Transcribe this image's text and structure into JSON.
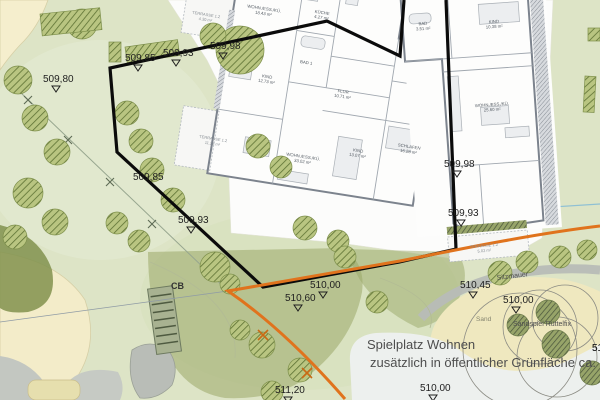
{
  "map": {
    "annotations": {
      "playground_line1": "Spielplatz Wohnen",
      "playground_line2": "zusätzlich in öffentlicher Grünfläche ca.",
      "seat_wall": "Sitzmauer",
      "sand": "Sand",
      "sand_play": "Sandspiel Rüttelfix",
      "cb": "CB",
      "partial_elevation": "51"
    },
    "elevation_markers": [
      {
        "label": "509,80",
        "x": 43,
        "y": 82
      },
      {
        "label": "509,85",
        "x": 125,
        "y": 61
      },
      {
        "label": "509,93",
        "x": 163,
        "y": 56
      },
      {
        "label": "509,98",
        "x": 210,
        "y": 49
      },
      {
        "label": "509,85",
        "x": 133,
        "y": 180,
        "tri": false
      },
      {
        "label": "509,93",
        "x": 178,
        "y": 223
      },
      {
        "label": "509,98",
        "x": 444,
        "y": 167
      },
      {
        "label": "509,93",
        "x": 448,
        "y": 216
      },
      {
        "label": "510,00",
        "x": 310,
        "y": 288
      },
      {
        "label": "510,60",
        "x": 285,
        "y": 301
      },
      {
        "label": "510,45",
        "x": 460,
        "y": 288
      },
      {
        "label": "510,00",
        "x": 503,
        "y": 303
      },
      {
        "label": "510,00",
        "x": 420,
        "y": 391
      },
      {
        "label": "511,20",
        "x": 275,
        "y": 393
      },
      {
        "label": "51",
        "x": 592,
        "y": 351,
        "tri": false
      }
    ],
    "rooms": [
      {
        "label": "WOHN./ESS./KÜ.",
        "area": "18.43 m²",
        "x": 264,
        "y": 10,
        "rot": 9
      },
      {
        "label": "KÜCHE",
        "area": "4.27 m²",
        "x": 322,
        "y": 14,
        "rot": 9
      },
      {
        "label": "KIND",
        "area": "12.73 m²",
        "x": 267,
        "y": 78,
        "rot": 9
      },
      {
        "label": "BAD 1",
        "area": "",
        "x": 306,
        "y": 64,
        "rot": 9
      },
      {
        "label": "FLUR",
        "area": "10.71 m²",
        "x": 343,
        "y": 93,
        "rot": 9
      },
      {
        "label": "WOHN./ESS./KÜ.",
        "area": "33.02 m²",
        "x": 303,
        "y": 158,
        "rot": 9
      },
      {
        "label": "KIND",
        "area": "13.07 m²",
        "x": 358,
        "y": 152,
        "rot": 9
      },
      {
        "label": "SCHLAFEN",
        "area": "16.28 m²",
        "x": 409,
        "y": 148,
        "rot": 9
      },
      {
        "label": "BAD",
        "area": "3.51 m²",
        "x": 423,
        "y": 25,
        "rot": -4
      },
      {
        "label": "KIND",
        "area": "10.38 m²",
        "x": 494,
        "y": 23,
        "rot": -4
      },
      {
        "label": "WOHN./ESS./KÜ.",
        "area": "25.60 m²",
        "x": 492,
        "y": 106,
        "rot": -4
      }
    ],
    "terraces": [
      {
        "label": "TERRASSE 1.2",
        "area": "4.30 m²",
        "x": 206,
        "y": 16,
        "rot": 9
      },
      {
        "label": "TERRASSE 1.2",
        "area": "11.28 m²",
        "x": 213,
        "y": 140,
        "rot": 9
      },
      {
        "label": "TERRASSE 1.2",
        "area": "5.02 m²",
        "x": 484,
        "y": 247,
        "rot": -5
      }
    ],
    "trees": [
      [
        18,
        80,
        14
      ],
      [
        35,
        118,
        13
      ],
      [
        57,
        152,
        13
      ],
      [
        28,
        193,
        15
      ],
      [
        55,
        222,
        13
      ],
      [
        15,
        237,
        12
      ],
      [
        127,
        113,
        12
      ],
      [
        141,
        141,
        12
      ],
      [
        152,
        170,
        12
      ],
      [
        173,
        200,
        12
      ],
      [
        117,
        223,
        11
      ],
      [
        139,
        241,
        11
      ],
      [
        82,
        24,
        15
      ],
      [
        240,
        50,
        24
      ],
      [
        213,
        36,
        13
      ],
      [
        258,
        146,
        12
      ],
      [
        281,
        167,
        11
      ],
      [
        305,
        228,
        12
      ],
      [
        338,
        241,
        11
      ],
      [
        215,
        267,
        15
      ],
      [
        345,
        257,
        11
      ],
      [
        230,
        284,
        10
      ],
      [
        377,
        302,
        11
      ],
      [
        262,
        345,
        13
      ],
      [
        300,
        370,
        12
      ],
      [
        272,
        392,
        11
      ],
      [
        240,
        330,
        10
      ],
      [
        500,
        273,
        12
      ],
      [
        527,
        262,
        11
      ],
      [
        560,
        257,
        11
      ],
      [
        587,
        250,
        10
      ]
    ],
    "hedges": [
      [
        40,
        14,
        60,
        22,
        -6
      ],
      [
        125,
        47,
        53,
        16,
        -8
      ],
      [
        109,
        42,
        12,
        20,
        0
      ],
      [
        588,
        28,
        12,
        13,
        0
      ],
      [
        585,
        76,
        11,
        36,
        3
      ]
    ],
    "colors": {
      "boundary": "#0b0b0b",
      "path_orange": "#e0731d",
      "grass": "#dde4c6",
      "sand": "#efe8bf",
      "mound": "#9aa768",
      "paper": "#fcfcfb",
      "water_line": "#8fc0d4"
    }
  }
}
